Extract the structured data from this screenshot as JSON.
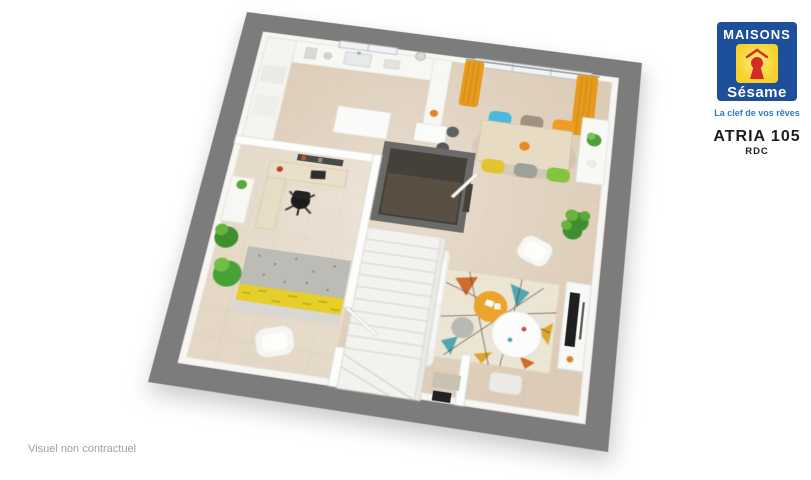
{
  "branding": {
    "logo": {
      "line1": "MAISONS",
      "line2": "Sésame",
      "tagline": "La clef de vos rêves",
      "colors": {
        "blue": "#1d4f9b",
        "yellow": "#f6d02c",
        "red": "#d42a28",
        "tagline_blue": "#2d7cc2"
      }
    },
    "model_name": "ATRIA 105",
    "floor_label": "RDC"
  },
  "footer": {
    "disclaimer": "Visuel non contractuel"
  },
  "floorplan": {
    "type": "3d-top-down-render",
    "rooms": [
      "kitchen",
      "dining-area",
      "living-room",
      "office",
      "staircase",
      "storage-closet",
      "entrance-hall"
    ],
    "colors": {
      "exterior_wall_gray": "#7c7c7c",
      "floor_beige": "#dccbb6",
      "office_floor": "#e4d7c5",
      "curtain_orange": "#e79b1d",
      "chair_teal": "#49b9da",
      "chair_taupe": "#a09184",
      "chair_orange": "#ef9d23",
      "chair_yellow": "#e2c52e",
      "chair_gray": "#9fa09a",
      "chair_green": "#84c440",
      "pouf_orange": "#eca32c",
      "rug_teal": "#4fa7ad",
      "rug_rust": "#cf6b2b",
      "rug_mustard": "#dca62e",
      "plant_green": "#4f9f3a"
    }
  }
}
